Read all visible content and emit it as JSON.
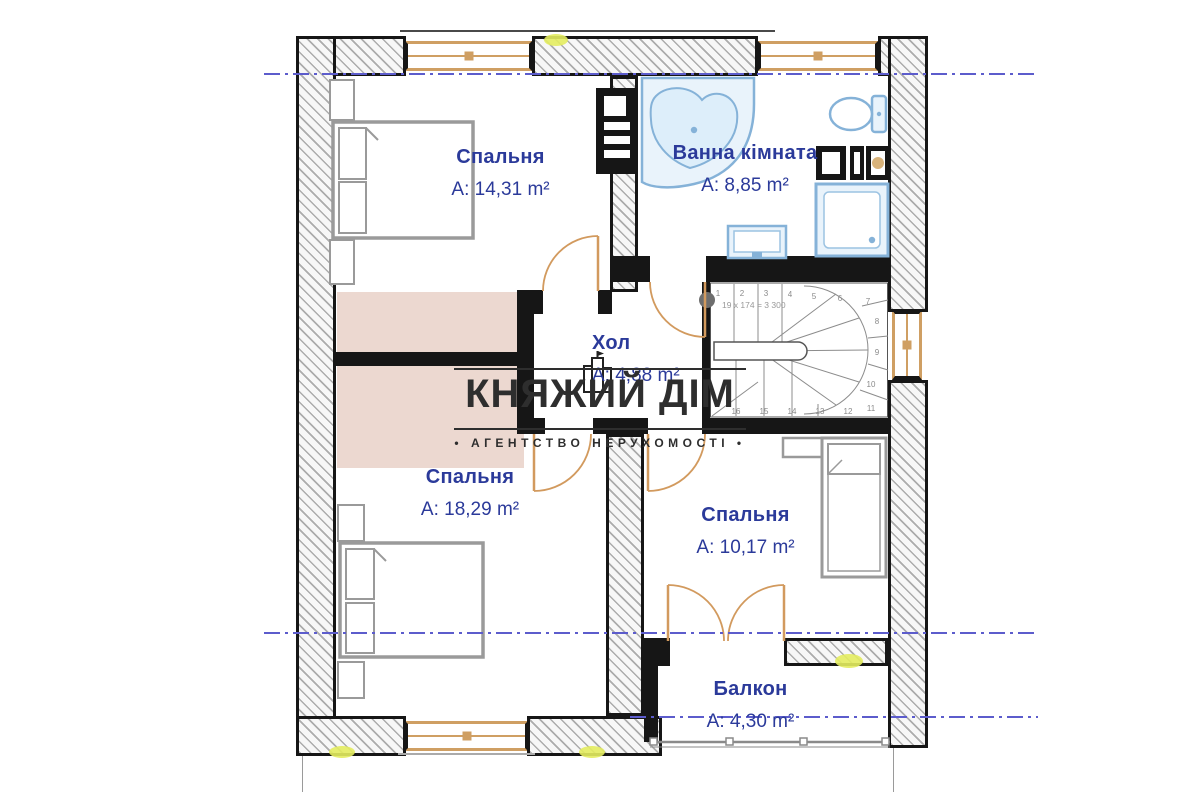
{
  "watermark": {
    "brand": "КНЯЖИЙ ДІМ",
    "tagline": "• АГЕНТСТВО НЕРУХОМОСТІ •"
  },
  "rooms": [
    {
      "name": "Спальня",
      "area": "A: 14,31 m²"
    },
    {
      "name": "Ванна кімната",
      "area": "A: 8,85 m²"
    },
    {
      "name": "Хол",
      "area": "A: 4,88 m²"
    },
    {
      "name": "Спальня",
      "area": "A: 18,29 m²"
    },
    {
      "name": "Спальня",
      "area": "A: 10,17 m²"
    },
    {
      "name": "Балкон",
      "area": "A: 4,30 m²"
    }
  ],
  "stairs": {
    "formula": "19 x 174 = 3 300",
    "steps": [
      "1",
      "2",
      "3",
      "4",
      "5",
      "6",
      "7",
      "8",
      "9",
      "10",
      "11",
      "12",
      "13",
      "14",
      "15",
      "16"
    ]
  },
  "fixtures": [
    "corner-bathtub",
    "toilet",
    "washing-machine",
    "laundry-box",
    "shower-cabin",
    "sink",
    "double-bed",
    "double-bed",
    "single-bed",
    "wardrobe-strip",
    "staircase",
    "balcony-railing"
  ],
  "colors": {
    "wall": "#161616",
    "labelblue": "#2b3a9a",
    "fixblue": "#85b2d8",
    "fixfill": "#e9f3fb",
    "doortan": "#d29a5e",
    "wintan": "#cf9f63",
    "pink": "#ecd8d0",
    "dash": "#5c5ccc",
    "marker": "#e3ec5f",
    "wmdark": "#2e2e2e",
    "furn": "#9a9a9a"
  }
}
